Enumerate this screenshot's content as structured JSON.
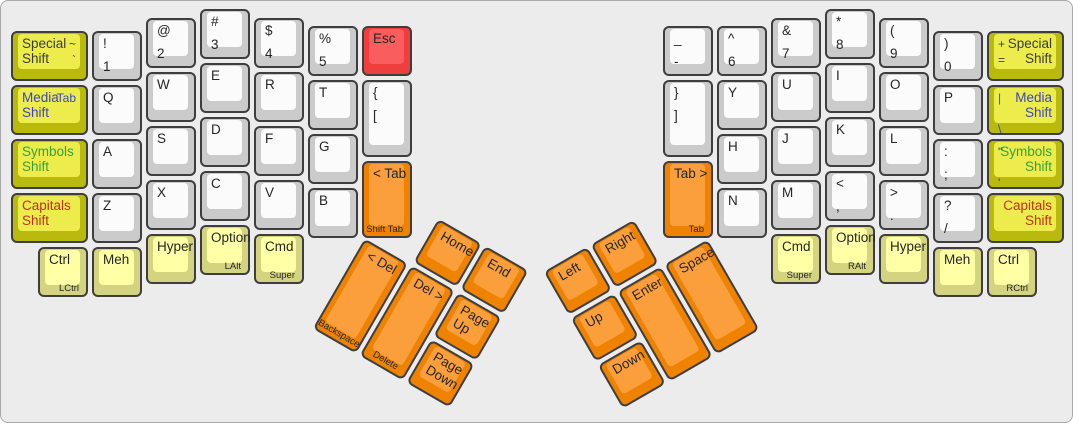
{
  "canvas": {
    "bg": "#ececec",
    "border": "#a9a9a9"
  },
  "palette": {
    "border": "#3e3e3e",
    "fg": "#262626",
    "white": {
      "side": "#cbcbcb",
      "top": "#fbfbfb"
    },
    "yellow": {
      "side": "#b9b90e",
      "top": "#ecec4d"
    },
    "paleyellow": {
      "side": "#d3d380",
      "top": "#ffffa6"
    },
    "orange": {
      "side": "#ef8300",
      "top": "#fb9f3d"
    },
    "red": {
      "side": "#ee3e3e",
      "top": "#f95d5d"
    }
  },
  "label_colors": {
    "special": "#3b3b3b",
    "media": "#3c46be",
    "symbols": "#37a03c",
    "capitals": "#bf3220"
  },
  "halves": {
    "left": {
      "keys": [
        {
          "id": "special-shift-left",
          "x": 8,
          "y": 28,
          "w": 81,
          "color": "yellow",
          "primary": [
            "Special",
            "Shift"
          ],
          "fg": "#3b3b3b",
          "secondary": [
            "~",
            "`"
          ],
          "secside": "right"
        },
        {
          "id": "media-shift-left",
          "x": 8,
          "y": 82,
          "w": 81,
          "color": "yellow",
          "primary": [
            "Media",
            "Shift"
          ],
          "fg": "#3c46be",
          "secondary": [
            "Tab"
          ],
          "secfg": "#3c46be",
          "secside": "right"
        },
        {
          "id": "symbols-shift-left",
          "x": 8,
          "y": 136,
          "w": 81,
          "color": "yellow",
          "primary": [
            "Symbols",
            "Shift"
          ],
          "fg": "#37a03c"
        },
        {
          "id": "capitals-shift-left",
          "x": 8,
          "y": 190,
          "w": 81,
          "color": "yellow",
          "primary": [
            "Capitals",
            "Shift"
          ],
          "fg": "#bf3220"
        },
        {
          "id": "1",
          "x": 89,
          "y": 28,
          "primary": [
            "!",
            "1"
          ],
          "spread": true
        },
        {
          "id": "q",
          "x": 89,
          "y": 82,
          "primary": [
            "Q"
          ]
        },
        {
          "id": "a",
          "x": 89,
          "y": 136,
          "primary": [
            "A"
          ]
        },
        {
          "id": "z",
          "x": 89,
          "y": 190,
          "primary": [
            "Z"
          ]
        },
        {
          "id": "2",
          "x": 143,
          "y": 15,
          "primary": [
            "@",
            "2"
          ],
          "spread": true
        },
        {
          "id": "w",
          "x": 143,
          "y": 69,
          "primary": [
            "W"
          ]
        },
        {
          "id": "s",
          "x": 143,
          "y": 123,
          "primary": [
            "S"
          ]
        },
        {
          "id": "x",
          "x": 143,
          "y": 177,
          "primary": [
            "X"
          ]
        },
        {
          "id": "hyper-left",
          "x": 143,
          "y": 231,
          "color": "paleyellow",
          "primary": [
            "Hyper"
          ]
        },
        {
          "id": "3",
          "x": 197,
          "y": 6,
          "primary": [
            "#",
            "3"
          ],
          "spread": true
        },
        {
          "id": "e",
          "x": 197,
          "y": 60,
          "primary": [
            "E"
          ]
        },
        {
          "id": "d",
          "x": 197,
          "y": 114,
          "primary": [
            "D"
          ]
        },
        {
          "id": "c",
          "x": 197,
          "y": 168,
          "primary": [
            "C"
          ]
        },
        {
          "id": "option-left",
          "x": 197,
          "y": 222,
          "color": "paleyellow",
          "primary": [
            "Option"
          ],
          "front": "LAlt"
        },
        {
          "id": "4",
          "x": 251,
          "y": 15,
          "primary": [
            "$",
            "4"
          ],
          "spread": true
        },
        {
          "id": "r",
          "x": 251,
          "y": 69,
          "primary": [
            "R"
          ]
        },
        {
          "id": "f",
          "x": 251,
          "y": 123,
          "primary": [
            "F"
          ]
        },
        {
          "id": "v",
          "x": 251,
          "y": 177,
          "primary": [
            "V"
          ]
        },
        {
          "id": "cmd-left",
          "x": 251,
          "y": 231,
          "color": "paleyellow",
          "primary": [
            "Cmd"
          ],
          "front": "Super"
        },
        {
          "id": "5",
          "x": 305,
          "y": 23,
          "primary": [
            "%",
            "5"
          ],
          "spread": true
        },
        {
          "id": "t",
          "x": 305,
          "y": 77,
          "primary": [
            "T"
          ]
        },
        {
          "id": "g",
          "x": 305,
          "y": 131,
          "primary": [
            "G"
          ]
        },
        {
          "id": "b",
          "x": 305,
          "y": 185,
          "primary": [
            "B"
          ]
        },
        {
          "id": "esc",
          "x": 359,
          "y": 23,
          "color": "red",
          "primary": [
            "Esc"
          ]
        },
        {
          "id": "bracket-open",
          "x": 359,
          "y": 77,
          "h": 81,
          "primary": [
            "{",
            "["
          ],
          "spread": true
        },
        {
          "id": "shift-tab",
          "x": 359,
          "y": 158,
          "h": 81,
          "color": "orange",
          "primary": [
            "< Tab"
          ],
          "front": "Shift Tab"
        },
        {
          "id": "ctrl-left",
          "x": 35,
          "y": 244,
          "color": "paleyellow",
          "primary": [
            "Ctrl"
          ],
          "front": "LCtrl"
        },
        {
          "id": "meh-left",
          "x": 89,
          "y": 244,
          "color": "paleyellow",
          "primary": [
            "Meh"
          ]
        }
      ]
    },
    "right": {
      "keys": [
        {
          "id": "minus",
          "x": 660,
          "y": 23,
          "primary": [
            "_",
            "-"
          ],
          "spread": true
        },
        {
          "id": "bracket-close",
          "x": 660,
          "y": 77,
          "h": 81,
          "primary": [
            "}",
            "]"
          ],
          "spread": true
        },
        {
          "id": "tab-right",
          "x": 660,
          "y": 158,
          "h": 81,
          "color": "orange",
          "primary": [
            "Tab >"
          ],
          "front": "Tab"
        },
        {
          "id": "6",
          "x": 714,
          "y": 23,
          "primary": [
            "^",
            "6"
          ],
          "spread": true
        },
        {
          "id": "y",
          "x": 714,
          "y": 77,
          "primary": [
            "Y"
          ]
        },
        {
          "id": "h",
          "x": 714,
          "y": 131,
          "primary": [
            "H"
          ]
        },
        {
          "id": "n",
          "x": 714,
          "y": 185,
          "primary": [
            "N"
          ]
        },
        {
          "id": "7",
          "x": 768,
          "y": 15,
          "primary": [
            "&",
            "7"
          ],
          "spread": true
        },
        {
          "id": "u",
          "x": 768,
          "y": 69,
          "primary": [
            "U"
          ]
        },
        {
          "id": "j",
          "x": 768,
          "y": 123,
          "primary": [
            "J"
          ]
        },
        {
          "id": "m",
          "x": 768,
          "y": 177,
          "primary": [
            "M"
          ]
        },
        {
          "id": "cmd-right",
          "x": 768,
          "y": 231,
          "color": "paleyellow",
          "primary": [
            "Cmd"
          ],
          "front": "Super"
        },
        {
          "id": "8",
          "x": 822,
          "y": 6,
          "primary": [
            "*",
            "8"
          ],
          "spread": true
        },
        {
          "id": "i",
          "x": 822,
          "y": 60,
          "primary": [
            "I"
          ]
        },
        {
          "id": "k",
          "x": 822,
          "y": 114,
          "primary": [
            "K"
          ]
        },
        {
          "id": "comma",
          "x": 822,
          "y": 168,
          "primary": [
            "<",
            ","
          ],
          "spread": true
        },
        {
          "id": "option-right",
          "x": 822,
          "y": 222,
          "color": "paleyellow",
          "primary": [
            "Option"
          ],
          "front": "RAlt"
        },
        {
          "id": "9",
          "x": 876,
          "y": 15,
          "primary": [
            "(",
            "9"
          ],
          "spread": true
        },
        {
          "id": "o",
          "x": 876,
          "y": 69,
          "primary": [
            "O"
          ]
        },
        {
          "id": "l",
          "x": 876,
          "y": 123,
          "primary": [
            "L"
          ]
        },
        {
          "id": "period",
          "x": 876,
          "y": 177,
          "primary": [
            ">",
            "."
          ],
          "spread": true
        },
        {
          "id": "hyper-right",
          "x": 876,
          "y": 231,
          "color": "paleyellow",
          "primary": [
            "Hyper"
          ]
        },
        {
          "id": "0",
          "x": 930,
          "y": 28,
          "primary": [
            ")",
            "0"
          ],
          "spread": true
        },
        {
          "id": "p",
          "x": 930,
          "y": 82,
          "primary": [
            "P"
          ]
        },
        {
          "id": "semicolon",
          "x": 930,
          "y": 136,
          "primary": [
            ":",
            ";"
          ],
          "spread": true
        },
        {
          "id": "slash",
          "x": 930,
          "y": 190,
          "primary": [
            "?",
            "/"
          ],
          "spread": true
        },
        {
          "id": "meh-right",
          "x": 930,
          "y": 244,
          "color": "paleyellow",
          "primary": [
            "Meh"
          ]
        },
        {
          "id": "special-shift-right",
          "x": 984,
          "y": 28,
          "w": 81,
          "color": "yellow",
          "primary": [
            "Special",
            "Shift"
          ],
          "align": "right",
          "fg": "#3b3b3b",
          "secondary": [
            "+",
            "="
          ],
          "secside": "left"
        },
        {
          "id": "media-shift-right",
          "x": 984,
          "y": 82,
          "w": 81,
          "color": "yellow",
          "primary": [
            "Media",
            "Shift"
          ],
          "align": "right",
          "fg": "#3c46be",
          "secondary": [
            "|",
            "\\"
          ],
          "secfg": "#3c46be",
          "secside": "left",
          "secspread": true
        },
        {
          "id": "symbols-shift-right",
          "x": 984,
          "y": 136,
          "w": 81,
          "color": "yellow",
          "primary": [
            "Symbols",
            "Shift"
          ],
          "align": "right",
          "fg": "#37a03c",
          "secondary": [
            "\"",
            "'"
          ],
          "secside": "left",
          "secspread": true
        },
        {
          "id": "capitals-shift-right",
          "x": 984,
          "y": 190,
          "w": 81,
          "color": "yellow",
          "primary": [
            "Capitals",
            "Shift"
          ],
          "align": "right",
          "fg": "#bf3220"
        },
        {
          "id": "ctrl-right",
          "x": 984,
          "y": 244,
          "color": "paleyellow",
          "primary": [
            "Ctrl"
          ],
          "front": "RCtrl"
        }
      ]
    }
  },
  "thumbs": {
    "left": {
      "x": 390,
      "y": 188,
      "angle": 30,
      "keys": [
        {
          "id": "home",
          "x": 54,
          "y": 0,
          "color": "orange",
          "primary": [
            "Home"
          ]
        },
        {
          "id": "end",
          "x": 108,
          "y": 0,
          "color": "orange",
          "primary": [
            "End"
          ]
        },
        {
          "id": "backspace",
          "x": 0,
          "y": 54,
          "h": 108,
          "color": "orange",
          "primary": [
            "< Del"
          ],
          "front": "Backspace",
          "frontCenter": true
        },
        {
          "id": "delete",
          "x": 54,
          "y": 54,
          "h": 108,
          "color": "orange",
          "primary": [
            "Del >"
          ],
          "front": "Delete",
          "frontCenter": true
        },
        {
          "id": "page-up",
          "x": 108,
          "y": 54,
          "color": "orange",
          "primary": [
            "Page",
            "Up"
          ]
        },
        {
          "id": "page-down",
          "x": 108,
          "y": 108,
          "color": "orange",
          "primary": [
            "Page",
            "Down"
          ]
        }
      ]
    },
    "right": {
      "x": 540,
      "y": 270,
      "angle": -30,
      "keys": [
        {
          "id": "arrow-left",
          "x": 0,
          "y": 0,
          "color": "orange",
          "primary": [
            "Left"
          ]
        },
        {
          "id": "arrow-right",
          "x": 54,
          "y": 0,
          "color": "orange",
          "primary": [
            "Right"
          ]
        },
        {
          "id": "arrow-up",
          "x": 0,
          "y": 54,
          "color": "orange",
          "primary": [
            "Up"
          ]
        },
        {
          "id": "enter",
          "x": 54,
          "y": 54,
          "h": 108,
          "color": "orange",
          "primary": [
            "Enter"
          ]
        },
        {
          "id": "space",
          "x": 108,
          "y": 54,
          "h": 108,
          "color": "orange",
          "primary": [
            "Space"
          ]
        },
        {
          "id": "arrow-down",
          "x": 0,
          "y": 108,
          "color": "orange",
          "primary": [
            "Down"
          ]
        }
      ]
    }
  }
}
